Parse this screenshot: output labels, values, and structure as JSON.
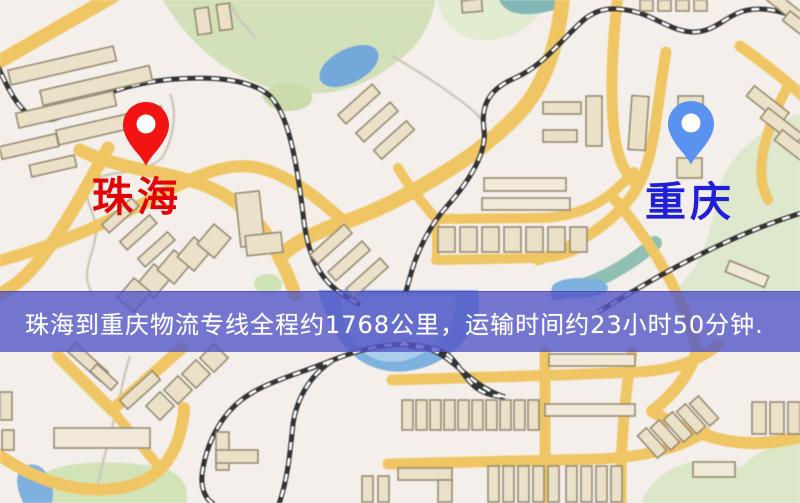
{
  "banner": {
    "text": "珠海到重庆物流专线全程约1768公里，运输时间约23小时50分钟.",
    "bg_color": "#5456c7",
    "text_color": "#ffffff"
  },
  "markers": {
    "origin": {
      "label": "珠海",
      "label_color": "#e30505",
      "pin_color": "#f21313"
    },
    "destination": {
      "label": "重庆",
      "label_color": "#1f1fd9",
      "pin_color": "#5a92f0"
    }
  },
  "map_colors": {
    "background": "#f5efeb",
    "road": "#f1c65f",
    "building": "#ebe1c8",
    "park": "#d7e4bd",
    "water": "#7db1e1",
    "railway": "#333333"
  }
}
